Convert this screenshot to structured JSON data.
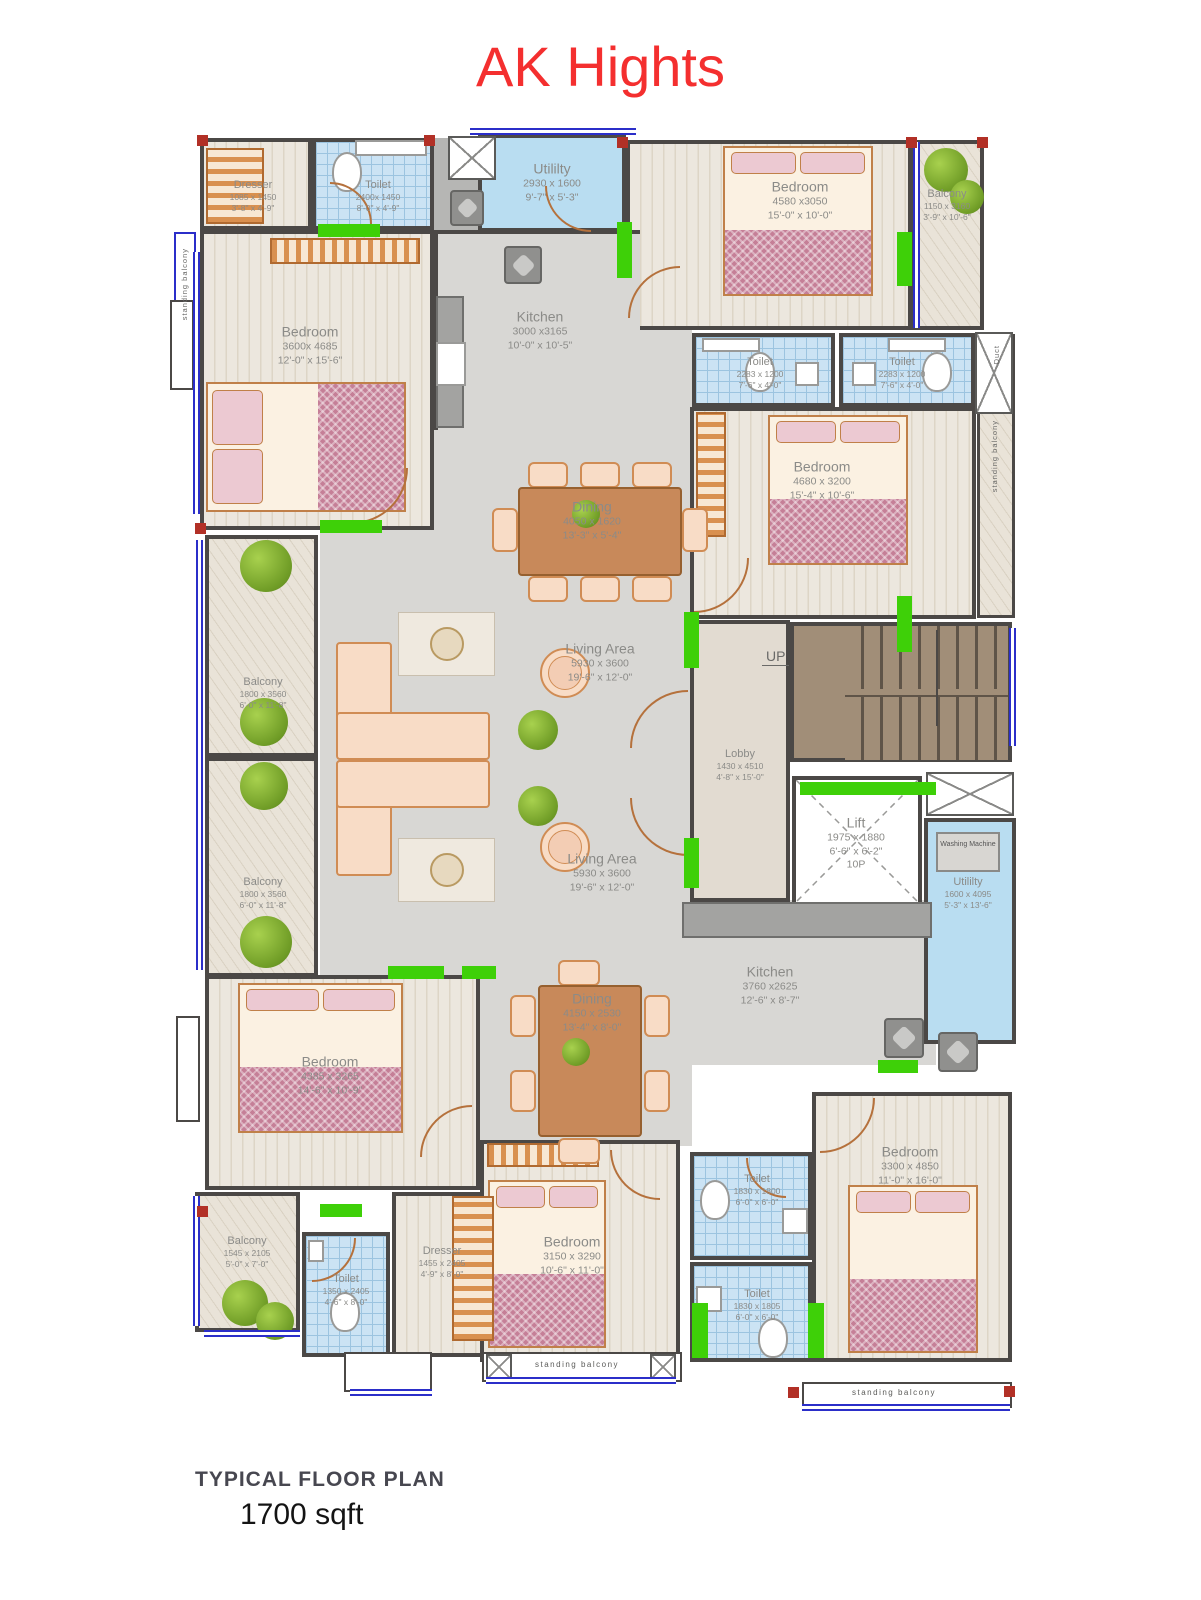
{
  "title": "AK Hights",
  "footer": {
    "line1": "TYPICAL  FLOOR PLAN",
    "line2": "1700 sqft"
  },
  "colors": {
    "title_red": "#f42f2f",
    "wall": "#4b4846",
    "window_green": "#3ed008",
    "window_blue": "#2b2ec9",
    "tile_blue": "#cbe3f4",
    "stair_brown": "#a18e78"
  },
  "stairs": {
    "up_label": "UP"
  },
  "washing_machine_label": "Washing Machine",
  "side_labels": {
    "left": "standing balcony",
    "right": "standing balcony",
    "bottom_center": "standing balcony",
    "bottom_right": "standing balcony",
    "duct": "Duct"
  },
  "rooms": {
    "dresser1": {
      "name": "Dresser",
      "mm": "1085 x 1450",
      "ft": "3'-8\" x 4'-9\""
    },
    "toilet1": {
      "name": "Toilet",
      "mm": "2400x 1450",
      "ft": "8'-0\" x 4'-9\""
    },
    "utility1": {
      "name": "Utililty",
      "mm": "2930 x 1600",
      "ft": "9'-7\" x 5'-3\""
    },
    "bedroom1": {
      "name": "Bedroom",
      "mm": "4580 x3050",
      "ft": "15'-0\" x 10'-0\""
    },
    "balcony1": {
      "name": "Balcony",
      "mm": "1150 x 3160",
      "ft": "3'-9\" x 10'-6\""
    },
    "bedroom2": {
      "name": "Bedroom",
      "mm": "3600x 4685",
      "ft": "12'-0\" x 15'-6\""
    },
    "kitchen1": {
      "name": "Kitchen",
      "mm": "3000 x3165",
      "ft": "10'-0\" x 10'-5\""
    },
    "toilet2": {
      "name": "Toilet",
      "mm": "2283 x 1200",
      "ft": "7'-6\" x 4'-0\""
    },
    "toilet3": {
      "name": "Toilet",
      "mm": "2283 x 1200",
      "ft": "7'-6\" x 4'-0\""
    },
    "bedroom3": {
      "name": "Bedroom",
      "mm": "4680 x 3200",
      "ft": "15'-4\" x 10'-6\""
    },
    "dining1": {
      "name": "Dining",
      "mm": "4050 x 1620",
      "ft": "13'-3\" x 5'-4\""
    },
    "balcony2": {
      "name": "Balcony",
      "mm": "1800 x 3560",
      "ft": "6'-0\" x 11'-8\""
    },
    "balcony3": {
      "name": "Balcony",
      "mm": "1800 x 3560",
      "ft": "6'-0\" x 11'-8\""
    },
    "living1": {
      "name": "Living Area",
      "mm": "5930 x 3600",
      "ft": "19'-6\" x 12'-0\""
    },
    "living2": {
      "name": "Living Area",
      "mm": "5930 x 3600",
      "ft": "19'-6\" x 12'-0\""
    },
    "lobby": {
      "name": "Lobby",
      "mm": "1430 x 4510",
      "ft": "4'-8\" x 15'-0\""
    },
    "lift": {
      "name": "Lift",
      "mm": "1975 x 1880",
      "ft": "6'-6\" x 6'-2\"",
      "extra": "10P"
    },
    "utility2": {
      "name": "Utililty",
      "mm": "1600 x 4095",
      "ft": "5'-3\" x 13'-6\""
    },
    "kitchen2": {
      "name": "Kitchen",
      "mm": "3760 x2625",
      "ft": "12'-6\" x 8'-7\""
    },
    "dining2": {
      "name": "Dining",
      "mm": "4150 x 2530",
      "ft": "13'-4\" x 8'-0\""
    },
    "bedroom4": {
      "name": "Bedroom",
      "mm": "4385 x 3265",
      "ft": "14'-6\" x 10'-9\""
    },
    "balcony4": {
      "name": "Balcony",
      "mm": "1545 x 2105",
      "ft": "5'-0\" x 7'-0\""
    },
    "toilet4": {
      "name": "Toilet",
      "mm": "1350 x 2405",
      "ft": "4'-6\" x 8'-0\""
    },
    "dresser2": {
      "name": "Dresser",
      "mm": "1455 x 2405",
      "ft": "4'-9\" x 8'-0\""
    },
    "bedroom5": {
      "name": "Bedroom",
      "mm": "3150 x 3290",
      "ft": "10'-6\" x 11'-0\""
    },
    "toilet5": {
      "name": "Toilet",
      "mm": "1830 x 1800",
      "ft": "6'-0\" x 6'-0\""
    },
    "toilet6": {
      "name": "Toilet",
      "mm": "1830 x 1805",
      "ft": "6'-0\" x 6'-0\""
    },
    "bedroom6": {
      "name": "Bedroom",
      "mm": "3300 x 4850",
      "ft": "11'-0\" x 16'-0\""
    }
  }
}
